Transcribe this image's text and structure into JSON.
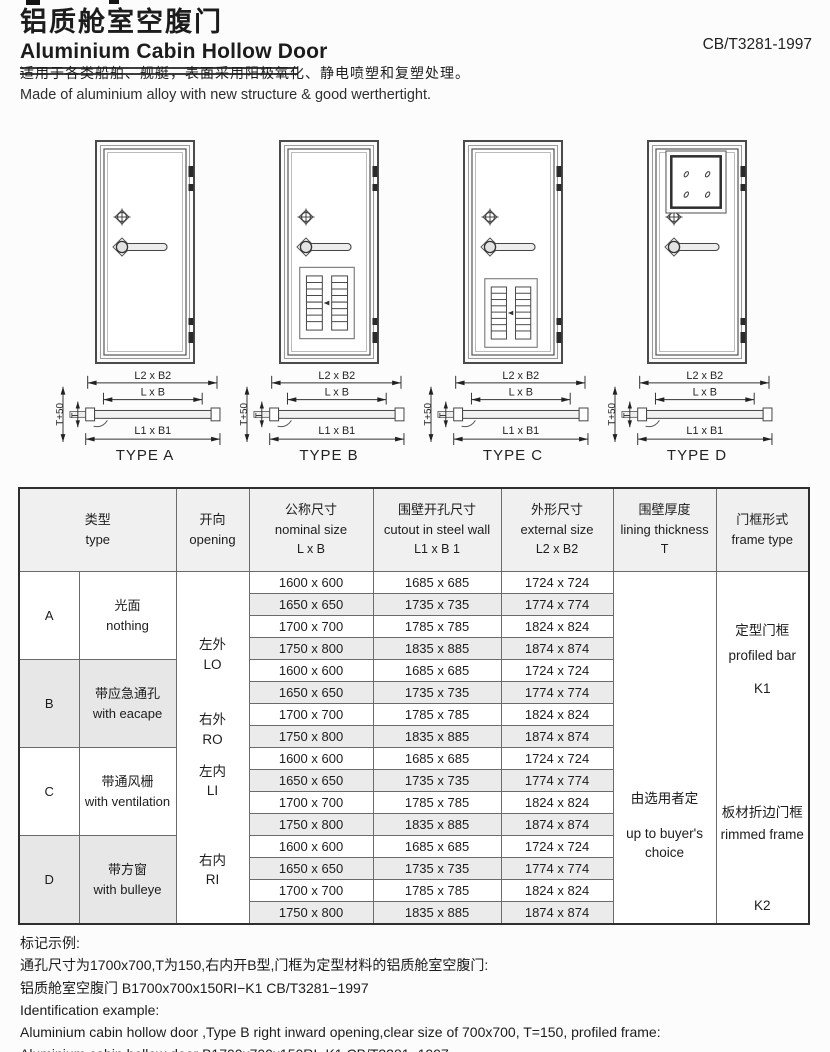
{
  "header": {
    "title_zh": "铝质舱室空腹门",
    "title_en": "Aluminium Cabin Hollow Door",
    "standard": "CB/T3281-1997",
    "desc_zh": "适用于各类船舶、舰艇，表面采用阳极氧化、静电喷塑和复塑处理。",
    "desc_en": "Made of aluminium alloy with new structure & good werthertight."
  },
  "diagrams": {
    "dim_external": "L2 x B2",
    "dim_nominal": "L x B",
    "dim_cutout": "L1 x B1",
    "dim_t50": "T+50",
    "dim_t": "T",
    "type_labels": [
      "TYPE A",
      "TYPE B",
      "TYPE C",
      "TYPE D"
    ]
  },
  "table": {
    "headers": {
      "type_zh": "类型",
      "type_en": "type",
      "opening_zh": "开向",
      "opening_en": "opening",
      "nominal_zh": "公称尺寸",
      "nominal_en": "nominal size",
      "nominal_sub": "L x B",
      "cutout_zh": "围壁开孔尺寸",
      "cutout_en": "cutout in steel wall",
      "cutout_sub": "L1 x B 1",
      "external_zh": "外形尺寸",
      "external_en": "external  size",
      "external_sub": "L2 x B2",
      "lining_zh": "围壁厚度",
      "lining_en": "lining thickness",
      "lining_sub": "T",
      "frame_zh": "门框形式",
      "frame_en": "frame type"
    },
    "sections": [
      {
        "letter": "A",
        "desc_zh": "光面",
        "desc_en": "nothing"
      },
      {
        "letter": "B",
        "desc_zh": "带应急通孔",
        "desc_en": "with eacape"
      },
      {
        "letter": "C",
        "desc_zh": "带通风栅",
        "desc_en": "with ventilation"
      },
      {
        "letter": "D",
        "desc_zh": "带方窗",
        "desc_en": "with bulleye"
      }
    ],
    "openings": [
      {
        "zh": "左外",
        "en": "LO"
      },
      {
        "zh": "右外",
        "en": "RO"
      },
      {
        "zh": "左内",
        "en": "LI"
      },
      {
        "zh": "右内",
        "en": "RI"
      }
    ],
    "size_rows": [
      {
        "nominal": "1600 x 600",
        "cutout": "1685 x 685",
        "external": "1724 x 724"
      },
      {
        "nominal": "1650 x 650",
        "cutout": "1735 x 735",
        "external": "1774 x 774"
      },
      {
        "nominal": "1700 x 700",
        "cutout": "1785 x 785",
        "external": "1824 x 824"
      },
      {
        "nominal": "1750 x 800",
        "cutout": "1835 x 885",
        "external": "1874 x 874"
      }
    ],
    "lining": {
      "zh": "由选用者定",
      "en_line1": "up to buyer's",
      "en_line2": "choice"
    },
    "frames": [
      {
        "zh": "定型门框",
        "en": "profiled bar",
        "code": "K1"
      },
      {
        "zh": "板材折边门框",
        "en": "rimmed frame",
        "code": "K2"
      }
    ]
  },
  "footer": {
    "title_zh": "标记示例:",
    "line1_zh": "通孔尺寸为1700x700,T为150,右内开B型,门框为定型材料的铝质舱室空腹门:",
    "line2_zh": "铝质舱室空腹门 B1700x700x150RI−K1 CB/T3281−1997",
    "title_en": "Identification example:",
    "line1_en": "Aluminium cabin hollow door ,Type B right inward opening,clear size of 700x700, T=150, profiled frame:",
    "line2_en": "Aluminium cabin hollow door B1700x700x150RI−K1 CB/T3281−1997"
  },
  "colors": {
    "row_alt": "#ebebeb",
    "section_shade": "#e7e7e7",
    "border": "#6b6b6b",
    "text": "#1c1c1c"
  }
}
